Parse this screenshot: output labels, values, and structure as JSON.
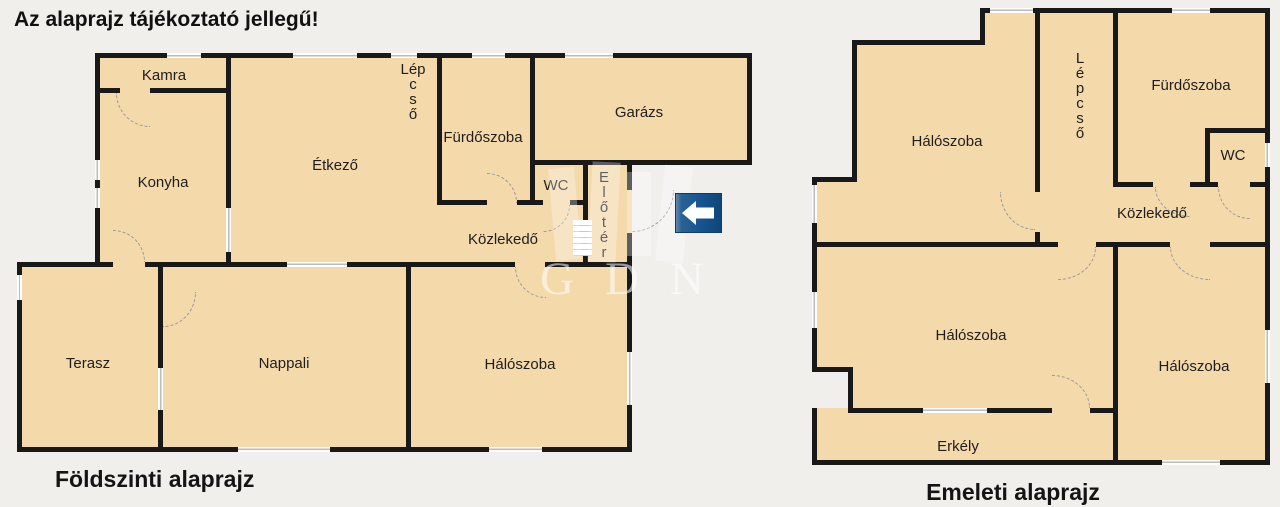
{
  "title": "Az alaprajz tájékoztató jellegű!",
  "watermark": {
    "text": "GDN"
  },
  "icons": {
    "direction_sign": "arrow-left"
  },
  "colors": {
    "bg": "#f1efec",
    "room": "#f4d9ab",
    "wall": "#191919",
    "text": "#1e1e1e",
    "winline": "#bbbbbb",
    "arc": "#999999",
    "signblue": "#155490",
    "wmw": "rgba(255,255,255,0.55)"
  },
  "ground_floor": {
    "caption": "Földszinti alaprajz",
    "rooms": {
      "kamra": "Kamra",
      "konyha": "Konyha",
      "etkezo": "Étkező",
      "lepcso": "Lép\nc\ns\nő",
      "furdoszoba": "Fürdőszoba",
      "garazs": "Garázs",
      "wc": "WC",
      "eloter": "E\nl\nő\nt\né\nr",
      "kozlekedo": "Közlekedő",
      "terasz": "Terasz",
      "nappali": "Nappali",
      "haloszoba": "Hálószoba"
    }
  },
  "upper_floor": {
    "caption": "Emeleti alaprajz",
    "rooms": {
      "haloszoba_1": "Hálószoba",
      "lepcso": "L\né\np\nc\ns\nő",
      "furdoszoba": "Fürdőszoba",
      "wc": "WC",
      "kozlekedo": "Közlekedő",
      "haloszoba_2": "Hálószoba",
      "haloszoba_3": "Hálószoba",
      "erkely": "Erkély"
    }
  }
}
